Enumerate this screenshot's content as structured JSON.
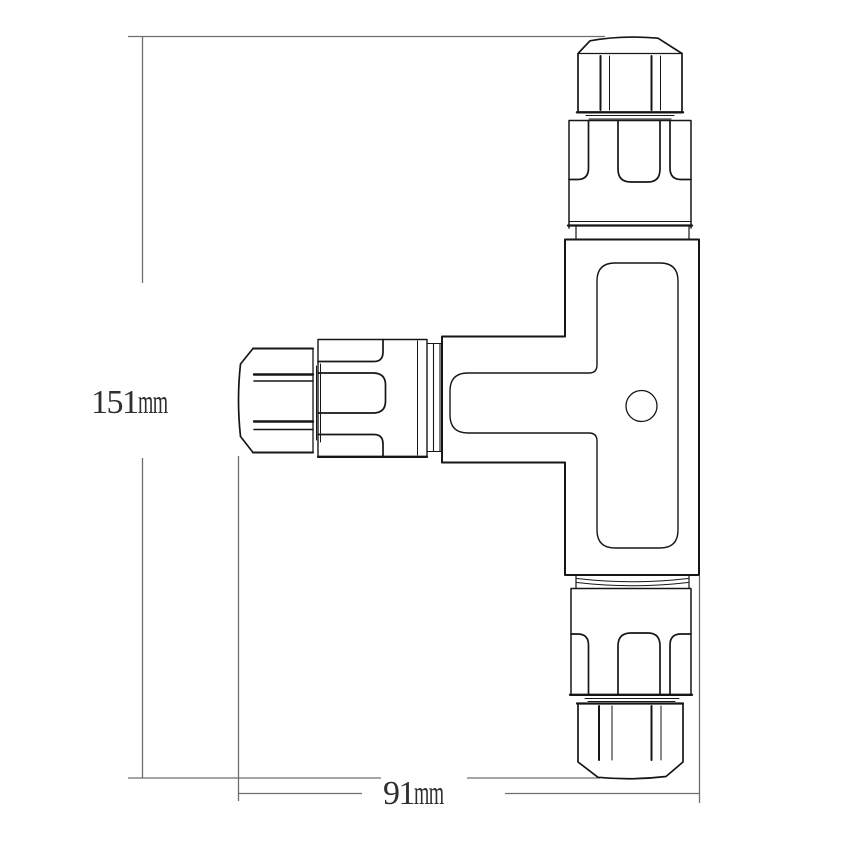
{
  "drawing": {
    "subject": "3-way T-shape cable connector, dimensioned line drawing"
  },
  "dimension_labels": {
    "height": {
      "value": "151",
      "unit": "mm"
    },
    "width": {
      "value": "91",
      "unit": "mm"
    }
  },
  "colors": {
    "background": "#ffffff",
    "part_outline": "#161616",
    "dimension_lines": "#6e6e6e",
    "label_text": "#2f2f2f"
  }
}
